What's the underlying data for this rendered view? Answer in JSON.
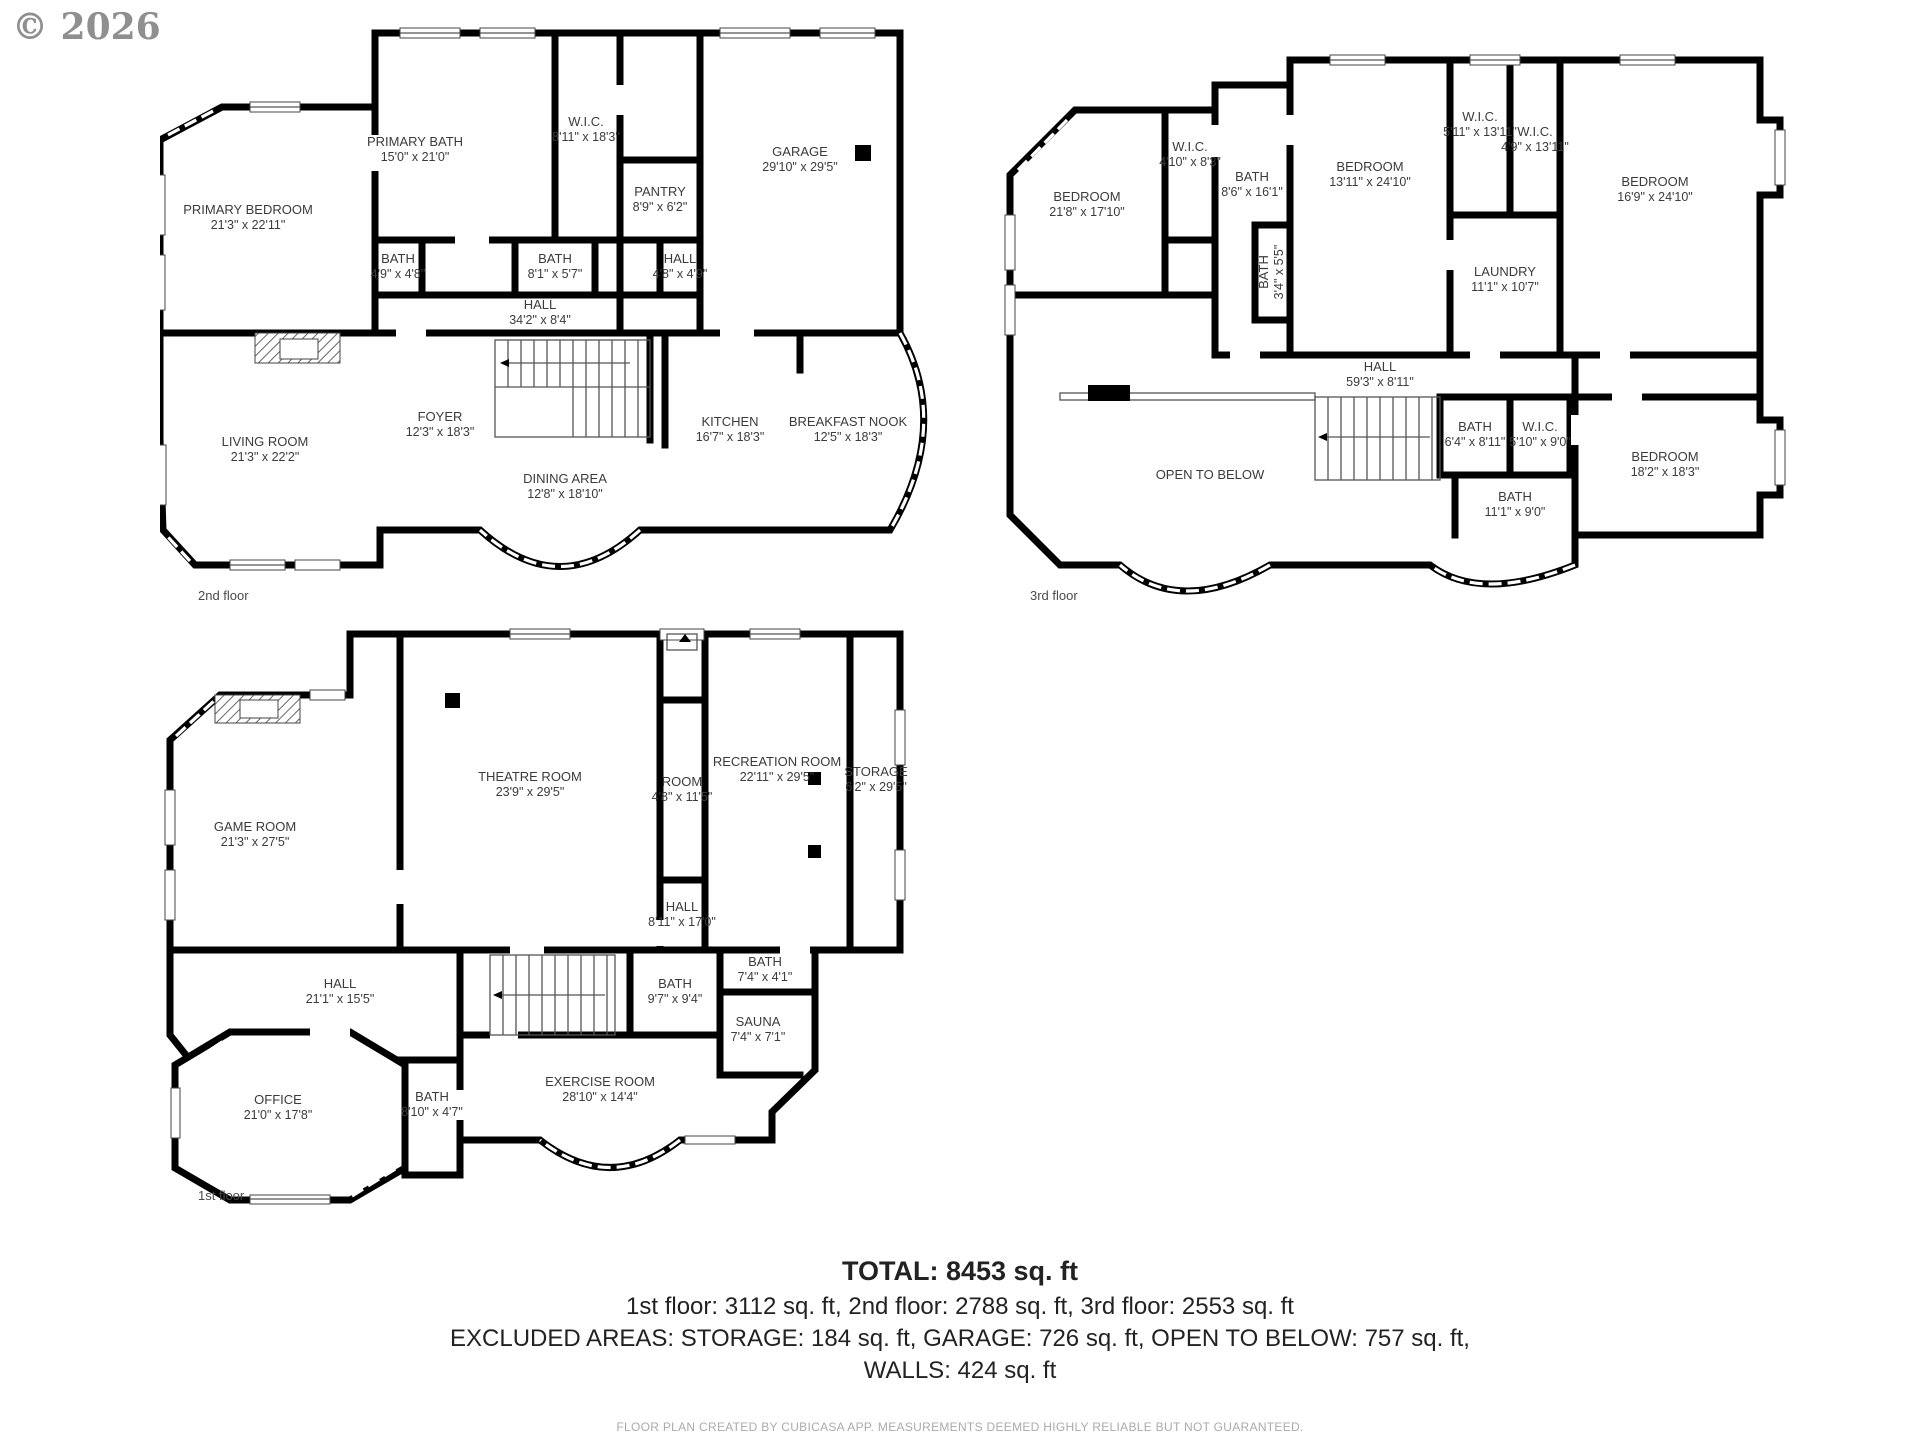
{
  "watermark": "© 2026",
  "plans": [
    {
      "label": "2nd floor",
      "rooms": [
        {
          "name": "PRIMARY BEDROOM",
          "dims": "21'3\" x 22'11\""
        },
        {
          "name": "PRIMARY BATH",
          "dims": "15'0\" x 21'0\""
        },
        {
          "name": "W.I.C.",
          "dims": "8'11\" x 18'3\""
        },
        {
          "name": "GARAGE",
          "dims": "29'10\" x 29'5\""
        },
        {
          "name": "PANTRY",
          "dims": "8'9\" x 6'2\""
        },
        {
          "name": "BATH",
          "dims": "4'9\" x 4'8\""
        },
        {
          "name": "BATH",
          "dims": "8'1\" x 5'7\""
        },
        {
          "name": "HALL",
          "dims": "4'8\" x 4'9\""
        },
        {
          "name": "HALL",
          "dims": "34'2\" x 8'4\""
        },
        {
          "name": "FOYER",
          "dims": "12'3\" x 18'3\""
        },
        {
          "name": "LIVING ROOM",
          "dims": "21'3\" x 22'2\""
        },
        {
          "name": "DINING AREA",
          "dims": "12'8\" x 18'10\""
        },
        {
          "name": "KITCHEN",
          "dims": "16'7\" x 18'3\""
        },
        {
          "name": "BREAKFAST NOOK",
          "dims": "12'5\" x 18'3\""
        }
      ]
    },
    {
      "label": "3rd floor",
      "rooms": [
        {
          "name": "BEDROOM",
          "dims": "21'8\" x 17'10\""
        },
        {
          "name": "W.I.C.",
          "dims": "4'10\" x 8'3\""
        },
        {
          "name": "BATH",
          "dims": "8'6\" x 16'1\""
        },
        {
          "name": "BATH",
          "dims": "3'4\" x 5'5\""
        },
        {
          "name": "BEDROOM",
          "dims": "13'11\" x 24'10\""
        },
        {
          "name": "W.I.C.",
          "dims": "5'11\" x 13'11\""
        },
        {
          "name": "W.I.C.",
          "dims": "4'9\" x 13'11\""
        },
        {
          "name": "LAUNDRY",
          "dims": "11'1\" x 10'7\""
        },
        {
          "name": "BEDROOM",
          "dims": "16'9\" x 24'10\""
        },
        {
          "name": "HALL",
          "dims": "59'3\" x 8'11\""
        },
        {
          "name": "BATH",
          "dims": "6'4\" x 8'11\""
        },
        {
          "name": "W.I.C.",
          "dims": "5'10\" x 9'0\""
        },
        {
          "name": "BATH",
          "dims": "11'1\" x 9'0\""
        },
        {
          "name": "OPEN TO BELOW",
          "dims": ""
        },
        {
          "name": "BEDROOM",
          "dims": "18'2\" x 18'3\""
        }
      ]
    },
    {
      "label": "1st floor",
      "rooms": [
        {
          "name": "GAME ROOM",
          "dims": "21'3\" x 27'5\""
        },
        {
          "name": "THEATRE ROOM",
          "dims": "23'9\" x 29'5\""
        },
        {
          "name": "RECREATION ROOM",
          "dims": "22'11\" x 29'5\""
        },
        {
          "name": "STORAGE",
          "dims": "6'2\" x 29'5\""
        },
        {
          "name": "ROOM",
          "dims": "4'8\" x 11'5\""
        },
        {
          "name": "HALL",
          "dims": "8'11\" x 17'0\""
        },
        {
          "name": "HALL",
          "dims": "21'1\" x 15'5\""
        },
        {
          "name": "BATH",
          "dims": "9'7\" x 9'4\""
        },
        {
          "name": "BATH",
          "dims": "7'4\" x 4'1\""
        },
        {
          "name": "SAUNA",
          "dims": "7'4\" x 7'1\""
        },
        {
          "name": "OFFICE",
          "dims": "21'0\" x 17'8\""
        },
        {
          "name": "BATH",
          "dims": "8'10\" x 4'7\""
        },
        {
          "name": "EXERCISE ROOM",
          "dims": "28'10\" x 14'4\""
        }
      ]
    }
  ],
  "summary": {
    "total_label": "TOTAL: 8453 sq. ft",
    "floors_line": "1st floor: 3112 sq. ft, 2nd floor: 2788 sq. ft, 3rd floor: 2553 sq. ft",
    "excluded_line": "EXCLUDED AREAS: STORAGE: 184 sq. ft, GARAGE: 726 sq. ft, OPEN TO BELOW: 757 sq. ft,",
    "walls_line": "WALLS: 424 sq. ft",
    "credit": "FLOOR PLAN CREATED BY CUBICASA APP. MEASUREMENTS DEEMED HIGHLY RELIABLE BUT NOT GUARANTEED."
  }
}
